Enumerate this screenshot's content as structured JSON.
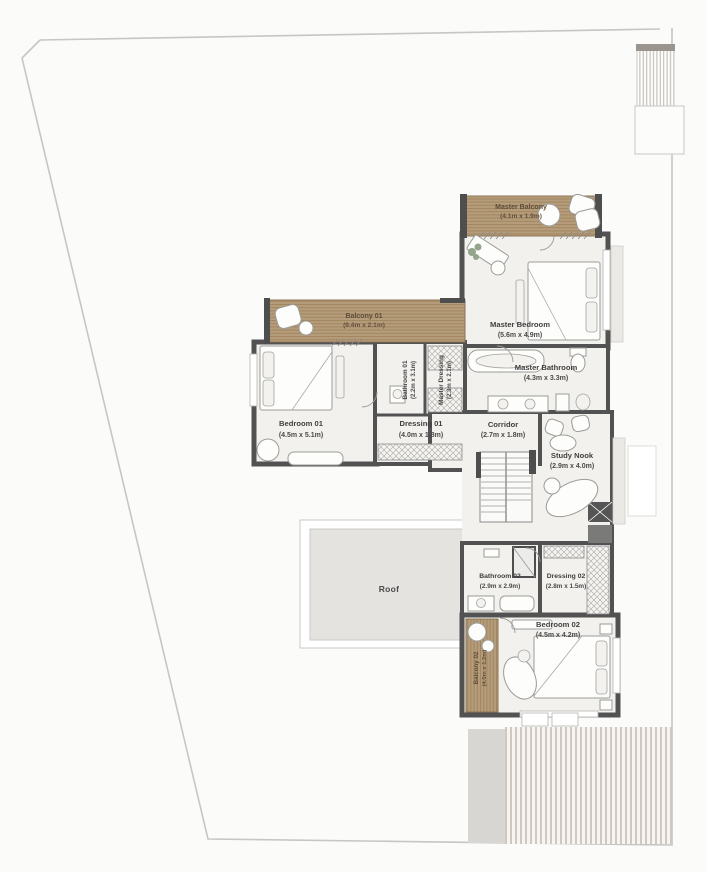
{
  "plan_title": "Upper floor plan",
  "rooms": {
    "master_balcony": {
      "name": "Master Balcony",
      "dims": "(4.1m x 1.9m)"
    },
    "master_bedroom": {
      "name": "Master Bedroom",
      "dims": "(5.6m x 4.9m)"
    },
    "master_bathroom": {
      "name": "Master Bathroom",
      "dims": "(4.3m x 3.3m)"
    },
    "bathroom_01": {
      "name": "Bathroom 01",
      "dims": "(2.2m x 3.1m)"
    },
    "master_dressing": {
      "name": "Master Dressing",
      "dims": "(2.3m x 2.1m)"
    },
    "balcony_01": {
      "name": "Balcony 01",
      "dims": "(9.4m x 2.1m)"
    },
    "bedroom_01": {
      "name": "Bedroom 01",
      "dims": "(4.5m x 5.1m)"
    },
    "dressing_01": {
      "name": "Dressing 01",
      "dims": "(4.0m x 1.8m)"
    },
    "corridor": {
      "name": "Corridor",
      "dims": "(2.7m x 1.8m)"
    },
    "study_nook": {
      "name": "Study Nook",
      "dims": "(2.9m x 4.0m)"
    },
    "roof": {
      "name": "Roof"
    },
    "bathroom_02": {
      "name": "Bathroom 02",
      "dims": "(2.9m x 2.9m)"
    },
    "dressing_02": {
      "name": "Dressing 02",
      "dims": "(2.8m x 1.5m)"
    },
    "bedroom_02": {
      "name": "Bedroom 02",
      "dims": "(4.5m x 4.2m)"
    },
    "balcony_02": {
      "name": "Balcony 02",
      "dims": "(4.0m x 1.2m)"
    }
  },
  "palette": {
    "wall": "#525252",
    "floor": "#f2f1ee",
    "wood_deck": "#b59c7b",
    "wood_line": "#a1865f",
    "roof_fill": "#e4e3e0",
    "boundary_line": "#c6c6c4",
    "deck_slat": "#ccc3bb",
    "side_strip": "#d7d6d3"
  }
}
